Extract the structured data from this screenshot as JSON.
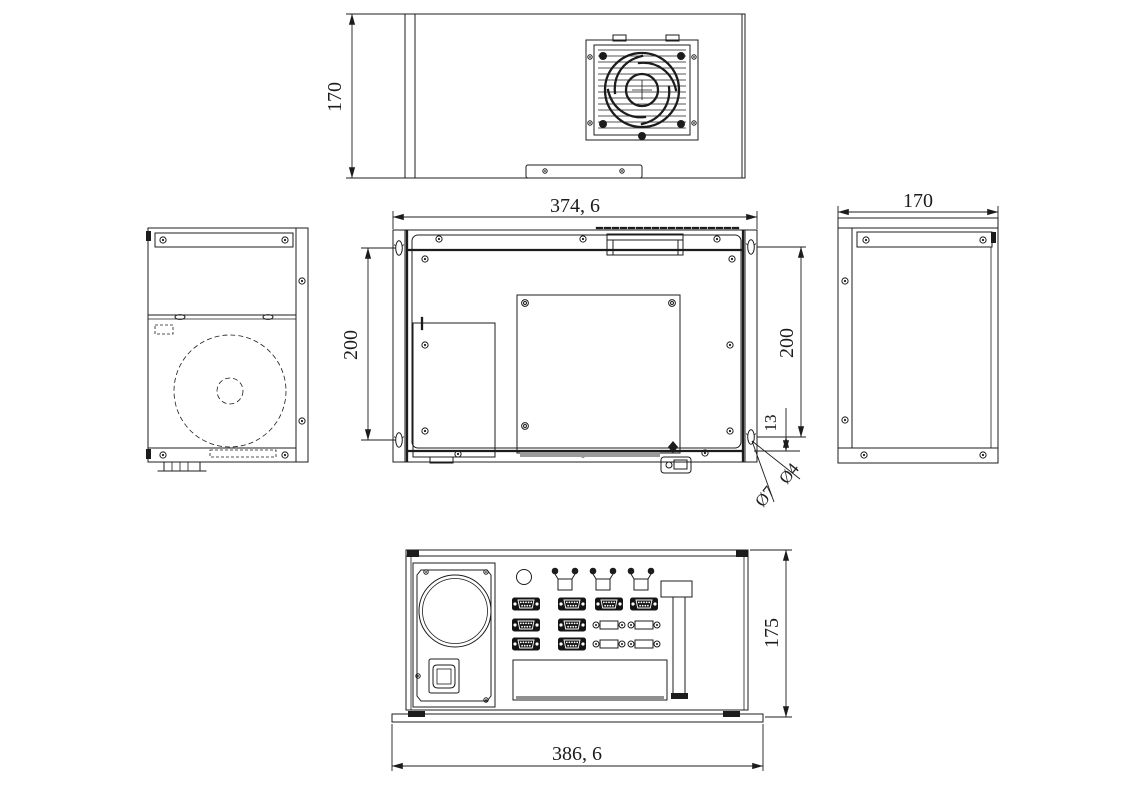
{
  "drawing": {
    "colors": {
      "line": "#1c1c1c",
      "background": "#ffffff",
      "shade": "#8f8f8f"
    },
    "dimensions": {
      "top_view_height": "170",
      "rear_width": "374, 6",
      "mount_span_left": "200",
      "mount_span_right": "200",
      "mount_edge_offset": "13",
      "keyhole_hole_diameter": "Ø7",
      "keyhole_slot_diameter": "Ø4",
      "side_view_depth": "170",
      "bottom_view_height": "175",
      "bottom_view_width": "386, 6"
    }
  }
}
